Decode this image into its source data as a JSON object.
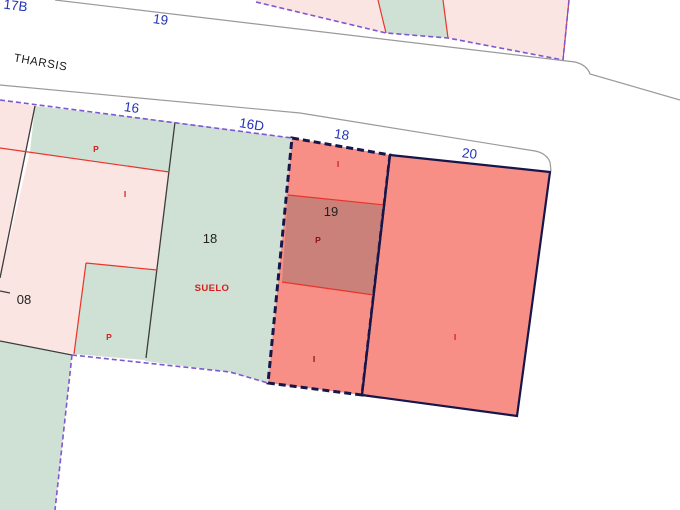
{
  "colors": {
    "background": "#ffffff",
    "parcel_pink": "#fbe5e3",
    "parcel_green": "#cfe1d5",
    "parcel_salmon": "#f78f86",
    "parcel_brick": "#c98179",
    "boundary_purple": "#7e57d2",
    "selection_navy": "#16164a",
    "line_gray": "#9a9a9a",
    "line_black": "#3c3c3c",
    "line_red": "#e8352b",
    "label_blue": "#2233bb",
    "label_black": "#222222",
    "label_red": "#d42020",
    "label_maroon": "#8b1010"
  },
  "street": {
    "name": "THARSIS"
  },
  "street_numbers": {
    "top_left": "17B",
    "top": "19",
    "n16": "16",
    "n16d": "16D",
    "n18": "18",
    "n20": "20"
  },
  "parcel_labels": {
    "p08": "08",
    "p18": "18",
    "p19": "19"
  },
  "construction_labels": {
    "left_strip_p": "P",
    "left_i": "I",
    "left_lower_p": "P",
    "suelo": "SUELO",
    "sel_top_i": "I",
    "sel_mid_p": "P",
    "sel_bottom_i": "I",
    "p20_i": "I"
  }
}
